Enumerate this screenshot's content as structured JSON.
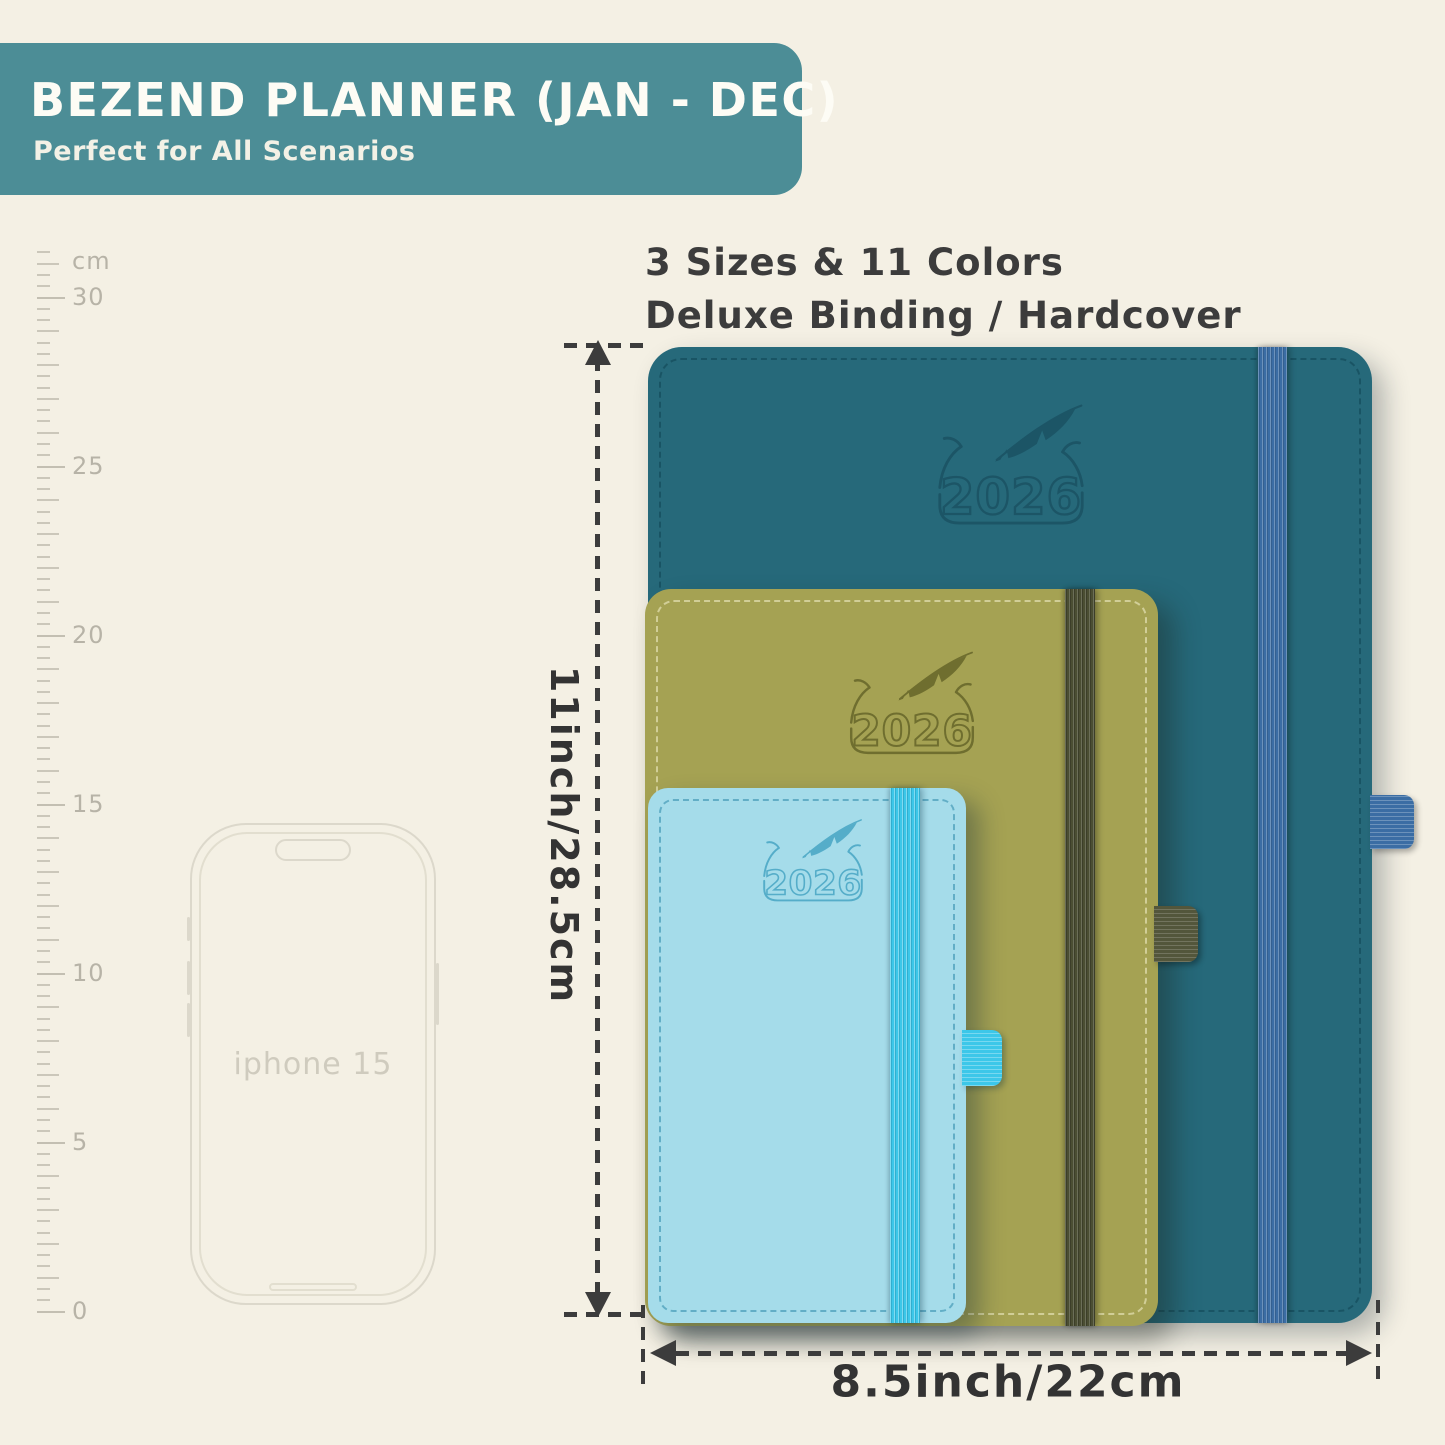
{
  "page": {
    "background_color": "#f4f0e4"
  },
  "banner": {
    "title": "BEZEND PLANNER (JAN - DEC)",
    "subtitle": "Perfect for All Scenarios",
    "background_color": "#4c8d96",
    "text_color": "#ffffff"
  },
  "features": {
    "line1": "3 Sizes & 11 Colors",
    "line2": "Deluxe Binding / Hardcover"
  },
  "ruler": {
    "unit_label": "cm",
    "labels": [
      "30",
      "25",
      "20",
      "15",
      "10",
      "5",
      "0"
    ]
  },
  "phone": {
    "label": "iphone 15"
  },
  "planners": [
    {
      "id": "large-teal",
      "year": "2026",
      "cover_color": "#26697a",
      "band_color": "#3b6da4",
      "stitch_color": "#17505f"
    },
    {
      "id": "medium-olive",
      "year": "2026",
      "cover_color": "#a5a253",
      "band_color": "#4b4e33",
      "stitch_color": "#ddd9a8"
    },
    {
      "id": "small-lightblue",
      "year": "2026",
      "cover_color": "#a5dcea",
      "band_color": "#3cc7e9",
      "stitch_color": "#3f96b4"
    }
  ],
  "dimensions": {
    "height_label": "11inch/28.5cm",
    "width_label": "8.5inch/22cm"
  }
}
